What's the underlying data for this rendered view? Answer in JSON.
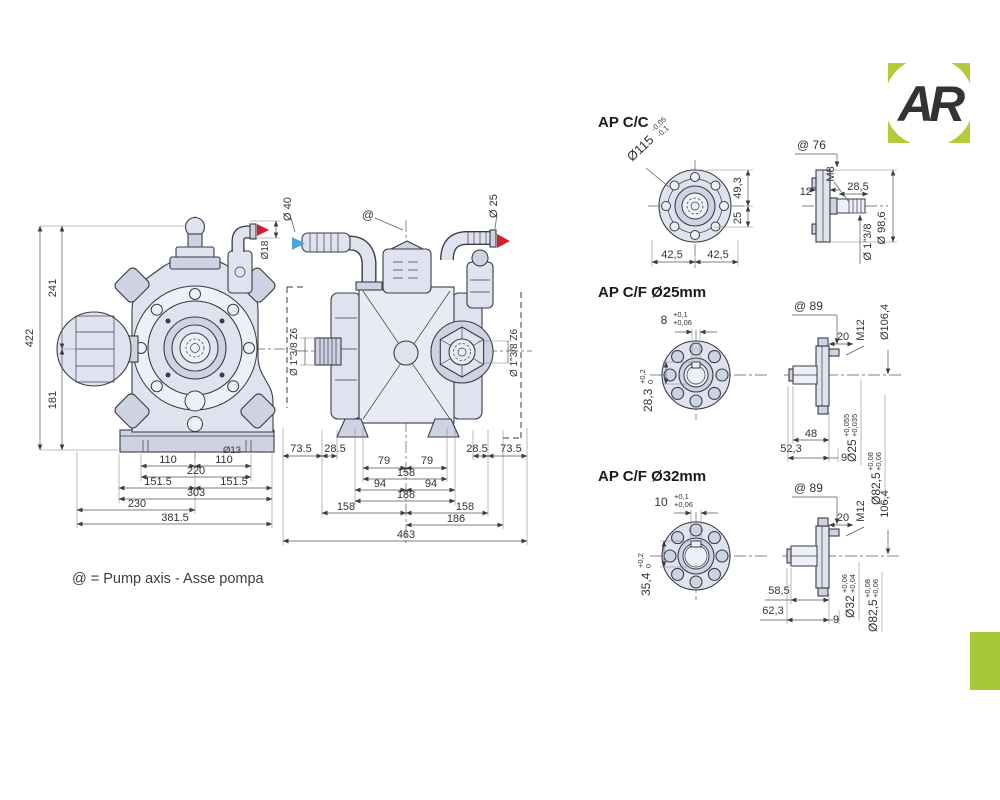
{
  "branding": {
    "logo_text": "AR",
    "logo_color": "#b3ca3b",
    "accent_bar_color": "#a6c939"
  },
  "legend": {
    "axis_note": "@ = Pump axis - Asse pompa"
  },
  "colors": {
    "line": "#3b3b43",
    "body_fill": "#dfe3f0",
    "inlet_arrow_blue": "#4da4d9",
    "outlet_arrow_red": "#cf2127"
  },
  "front_view": {
    "overall_height": "422",
    "axis_to_top": "241",
    "axis_to_base": "181",
    "outlet_diameter": "Ø18",
    "slot_diameter": "Ø13",
    "hole_pitch_left": "110",
    "hole_pitch_right": "110",
    "hole_span": "220",
    "foot_left": "151.5",
    "foot_right": "151.5",
    "foot_span": "303",
    "base_width": "230",
    "overall_width": "381.5"
  },
  "side_view": {
    "inlet_diameter": "Ø 40",
    "outlet_diameter": "Ø 25",
    "axis_symbol": "@",
    "shaft_left": "Ø 1\"3/8 Z6",
    "shaft_right": "Ø 1\"3/8 Z6",
    "dim_73_5_left": "73.5",
    "dim_28_5_left": "28.5",
    "dim_79_left": "79",
    "dim_79_right": "79",
    "dim_158_top": "158",
    "dim_94_left": "94",
    "dim_94_right": "94",
    "dim_188": "188",
    "dim_158_left": "158",
    "dim_158_right": "158",
    "dim_186": "186",
    "dim_28_5_right": "28.5",
    "dim_73_5_right": "73.5",
    "overall_length": "463"
  },
  "variant_cc": {
    "title": "AP C/C",
    "flange_diameter": "Ø115",
    "flange_tol_upper": "-0,05",
    "flange_tol_lower": "-0,1",
    "dim_49_3": "49,3",
    "dim_25": "25",
    "dim_42_5_left": "42,5",
    "dim_42_5_right": "42,5",
    "axis_to_face": "@ 76",
    "thread": "M8",
    "plate_thickness": "12",
    "shaft_length": "28,5",
    "shaft_diameter": "Ø 1\"3/8",
    "pilot_diameter": "Ø 98,6"
  },
  "variant_f25": {
    "title": "AP C/F Ø25mm",
    "key_width": "8",
    "key_width_tol_upper": "+0,1",
    "key_width_tol_lower": "+0,06",
    "key_height": "28,3",
    "key_height_tol_upper": "+0,2",
    "key_height_tol_lower": "0",
    "axis_to_face": "@ 89",
    "dim_20": "20",
    "thread": "M12",
    "flange_od": "Ø106,4",
    "shaft_diameter": "Ø25",
    "shaft_tol_upper": "+0,055",
    "shaft_tol_lower": "+0,035",
    "pilot_diameter": "Ø82,5",
    "pilot_tol_upper": "+0,08",
    "pilot_tol_lower": "+0,06",
    "dim_48": "48",
    "dim_52_3": "52,3",
    "dim_9": "9"
  },
  "variant_f32": {
    "title": "AP C/F Ø32mm",
    "key_width": "10",
    "key_width_tol_upper": "+0,1",
    "key_width_tol_lower": "+0,06",
    "key_height": "35,4",
    "key_height_tol_upper": "+0,2",
    "key_height_tol_lower": "0",
    "axis_to_face": "@ 89",
    "dim_20": "20",
    "thread": "M12",
    "flange_od": "106,4",
    "shaft_diameter": "Ø32",
    "shaft_tol_upper": "+0,06",
    "shaft_tol_lower": "+0,04",
    "pilot_diameter": "Ø82,5",
    "pilot_tol_upper": "+0,08",
    "pilot_tol_lower": "+0,06",
    "dim_58_5": "58,5",
    "dim_62_3": "62,3",
    "dim_9": "9"
  }
}
